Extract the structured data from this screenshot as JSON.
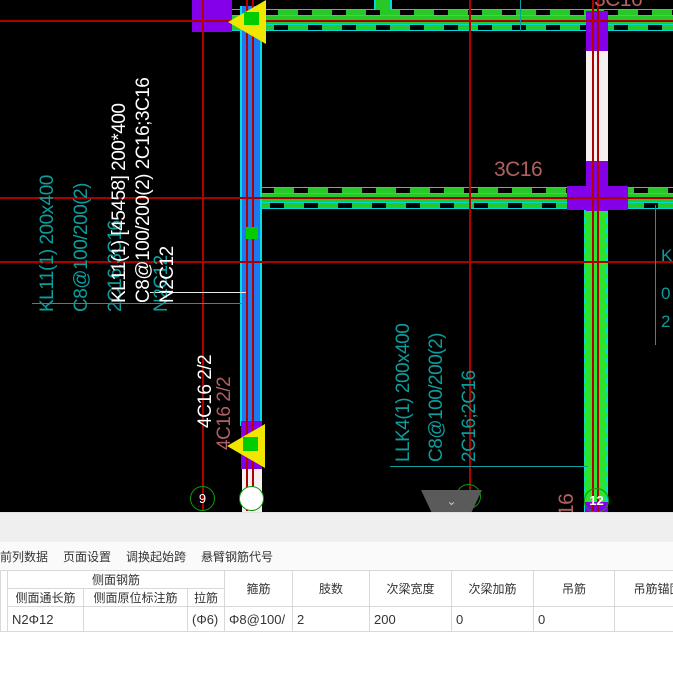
{
  "canvas": {
    "labels": {
      "teal_line1": "KL11(1) 200x400",
      "teal_line2": "C8@100/200(2)",
      "teal_line3": "2C16;3C16",
      "teal_line4": "N2C12",
      "white_line1": "KL11(1) [45458] 200*400",
      "white_line2": "C8@100/200(2) 2C16;3C16",
      "white_line3": "N2C12",
      "top_right_3c16": "3C16",
      "mid_3c16": "3C16",
      "white_4c16": "4C16 2/2",
      "red_4c16": "4C16 2/2",
      "red_16": "16",
      "llk_line1": "LLK4(1) 200x400",
      "llk_line2": "C8@100/200(2)",
      "llk_line3": "2C16;2C16",
      "edge_char1": "K",
      "edge_char2": "0",
      "edge_char3": "2"
    },
    "bubbles": {
      "b9": "9",
      "b10": "",
      "b11": "11",
      "b12": "12"
    },
    "collapse_button": {
      "chevron": "⌄"
    }
  },
  "panel": {
    "tabs": [
      {
        "label": "前列数据"
      },
      {
        "label": "页面设置"
      },
      {
        "label": "调换起始跨"
      },
      {
        "label": "悬臂钢筋代号"
      }
    ],
    "table": {
      "group_header": "侧面钢筋",
      "headers": {
        "col1": "侧面通长筋",
        "col2": "侧面原位标注筋",
        "col3": "拉筋",
        "col4": "箍筋",
        "col5": "肢数",
        "col6": "次梁宽度",
        "col7": "次梁加筋",
        "col8": "吊筋",
        "col9": "吊筋锚固"
      },
      "row": {
        "side_through_bar": "N2Φ12",
        "side_insitu_bar": "",
        "tie_bar": "(Φ6)",
        "stirrup": "Φ8@100/",
        "legs": "2",
        "secondary_beam_width": "200",
        "secondary_beam_add": "0",
        "hanging_bar": "0",
        "hanging_anchor": ""
      }
    }
  },
  "colors": {
    "beam_green": "#28c828",
    "beam_green_vertical": "#2be42b",
    "beam_edge_cyan": "#00d9d9",
    "rebar_blue": "#1f78f0",
    "column_purple": "#8400e8",
    "grid_red": "#b00000",
    "annotation_teal": "#0d9d9d",
    "annotation_red": "#b06060",
    "highlight_white": "#ffffff",
    "selection_yellow": "#f0e600",
    "bubble_green": "#0a9a0a",
    "panel_gray": "#efefef"
  }
}
